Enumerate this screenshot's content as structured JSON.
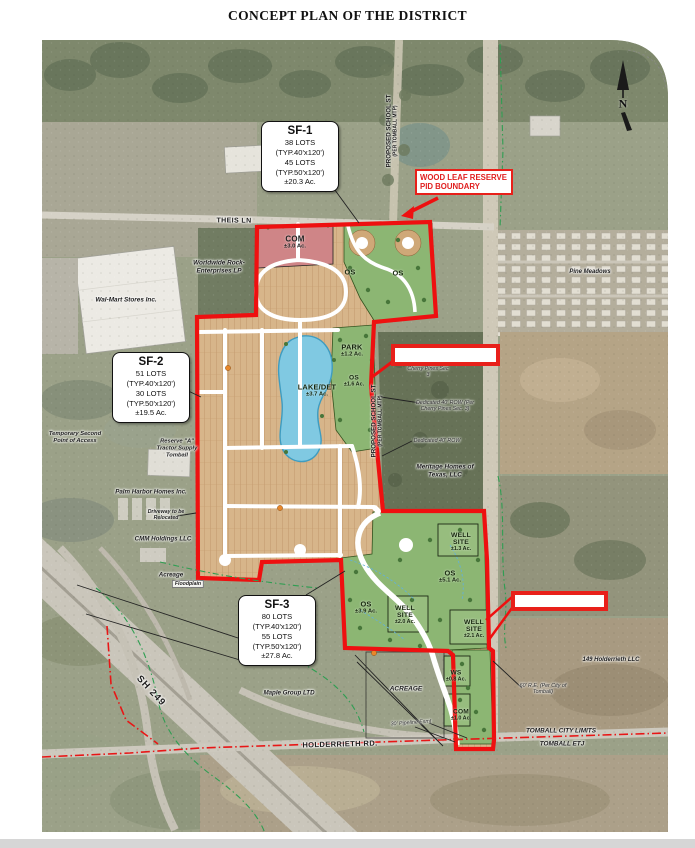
{
  "title": "CONCEPT PLAN OF THE DISTRICT",
  "north_label": "N",
  "boxes": {
    "sf1": {
      "lines": [
        "SF-1",
        "38 LOTS",
        "(TYP.40'x120')",
        "45 LOTS",
        "(TYP.50'x120')",
        "±20.3 Ac."
      ]
    },
    "sf2": {
      "lines": [
        "SF-2",
        "51 LOTS",
        "(TYP.40'x120')",
        "30 LOTS",
        "(TYP.50'x120')",
        "±19.5 Ac."
      ]
    },
    "sf3": {
      "lines": [
        "SF-3",
        "80 LOTS",
        "(TYP.40'x120')",
        "55 LOTS",
        "(TYP.50'x120')",
        "±27.8 Ac."
      ]
    },
    "pid": {
      "line1": "WOOD LEAF RESERVE",
      "line2": "PID BOUNDARY"
    }
  },
  "zones": [
    {
      "name": "COM",
      "ac": "±3.0 Ac."
    },
    {
      "name": "OS"
    },
    {
      "name": "OS"
    },
    {
      "name": "PARK",
      "ac": "±1.2 Ac."
    },
    {
      "name": "LAKE/DET",
      "ac": "±3.7 Ac."
    },
    {
      "name": "OS",
      "ac": "±1.6 Ac."
    },
    {
      "name": "WELL",
      "name2": "SITE",
      "ac": "±1.3 Ac."
    },
    {
      "name": "OS",
      "ac": "±5.1 Ac."
    },
    {
      "name": "OS",
      "ac": "±3.9 Ac."
    },
    {
      "name": "WELL",
      "name2": "SITE",
      "ac": "±2.0 Ac."
    },
    {
      "name": "WELL",
      "name2": "SITE",
      "ac": "±2.1 Ac."
    },
    {
      "name": "WS",
      "ac": "±0.8 Ac."
    },
    {
      "name": "COM",
      "ac": "±1.0 Ac."
    }
  ],
  "roads": {
    "theis": "THEIS LN",
    "sh249": "SH 249",
    "holderrieth": "HOLDERRIETH RD.",
    "school_line1": "PROPOSED SCHOOL ST",
    "school_line2": "(PER TOMBALL MTP)",
    "tomball_limits": "TOMBALL CITY LIMITS",
    "tomball_etj": "TOMBALL ETJ"
  },
  "owners": {
    "walmart": "Wal-Mart Stores Inc.",
    "worldwide": "Worldwide Rock-Enterprises LP",
    "pine_meadows": "Pine Meadows",
    "temp_access": "Temporary Second Point of Access",
    "reserve_a": "Reserve \"A\" Tractor Supply Tomball",
    "palm_harbor": "Palm Harbor Homes Inc.",
    "driveway": "Driveway to be Relocated",
    "cmm": "CMM Holdings LLC",
    "acreage_sw": "Acreage",
    "floodplain": "Floodplain",
    "meritage": "Meritage Homes of Texas, LLC",
    "maple": "Maple Group LTD",
    "acreage_s": "ACREAGE",
    "holderrieth_llc": "149 Holderrieth LLC"
  },
  "notes": {
    "row1": "Dedicated 40' ROW (Per Cherry Pines Sec. 3)",
    "row2": "Dedicated 40' ROW",
    "cherry": "Cherry Pines Sec 3",
    "pipeline": "30' Pipeline Esmt",
    "roe": "60' R.E. (Per City of Tomball)"
  },
  "colors": {
    "boundary_red": "#ee1010",
    "callout_red": "#e8201a",
    "lots_tan": "#d2a97c",
    "open_space_green": "#8cb673",
    "lake_blue": "#80c9e2",
    "commercial_pink": "#cf8587"
  }
}
